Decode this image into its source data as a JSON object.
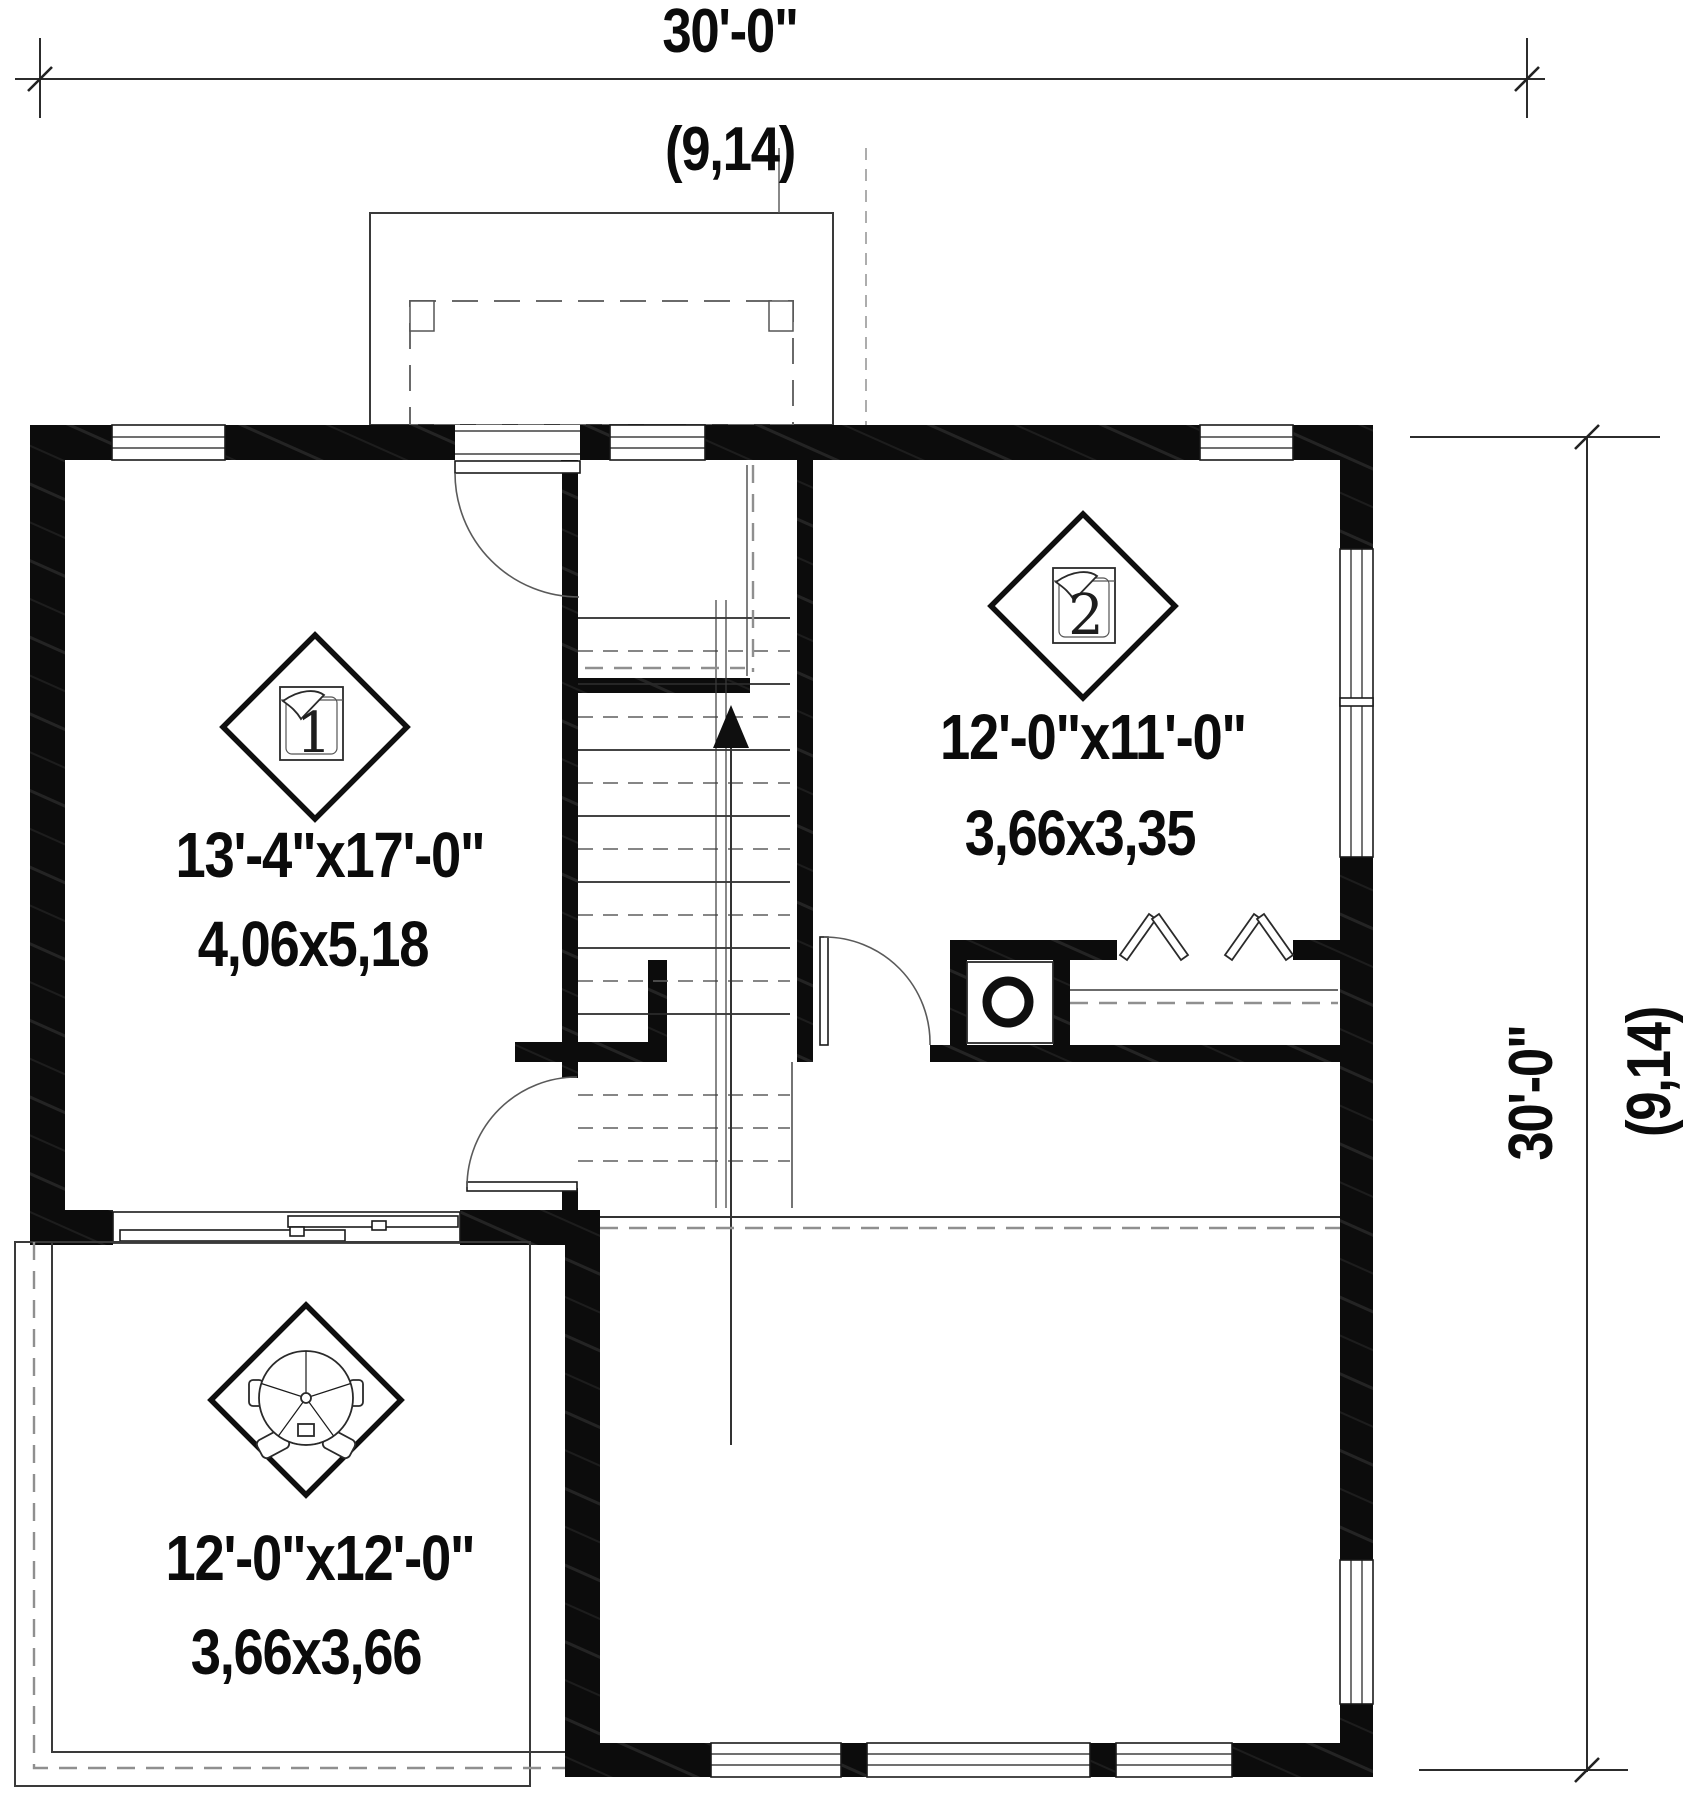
{
  "dimensions": {
    "top": {
      "feet": "30'-0\"",
      "meters": "(9,14)"
    },
    "right": {
      "feet": "30'-0\"",
      "meters": "(9,14)"
    }
  },
  "rooms": {
    "bedroom1": {
      "number": "1",
      "feet": "13'-4\"x17'-0\"",
      "meters": "4,06x5,18"
    },
    "bedroom2": {
      "number": "2",
      "feet": "12'-0\"x11'-0\"",
      "meters": "3,66x3,35"
    },
    "terrace": {
      "feet": "12'-0\"x12'-0\"",
      "meters": "3,66x3,66"
    }
  },
  "icons": {
    "bedroom1_marker": "bed-icon",
    "bedroom2_marker": "bed-icon",
    "terrace_marker": "patio-table-icon",
    "laundry": "washer-icon",
    "stairs": "stairs-up-arrow-icon"
  },
  "colors": {
    "wall": "#0c0c0c",
    "line": "#2a2a2a",
    "dashed": "#8f8f8f",
    "background": "#ffffff"
  }
}
